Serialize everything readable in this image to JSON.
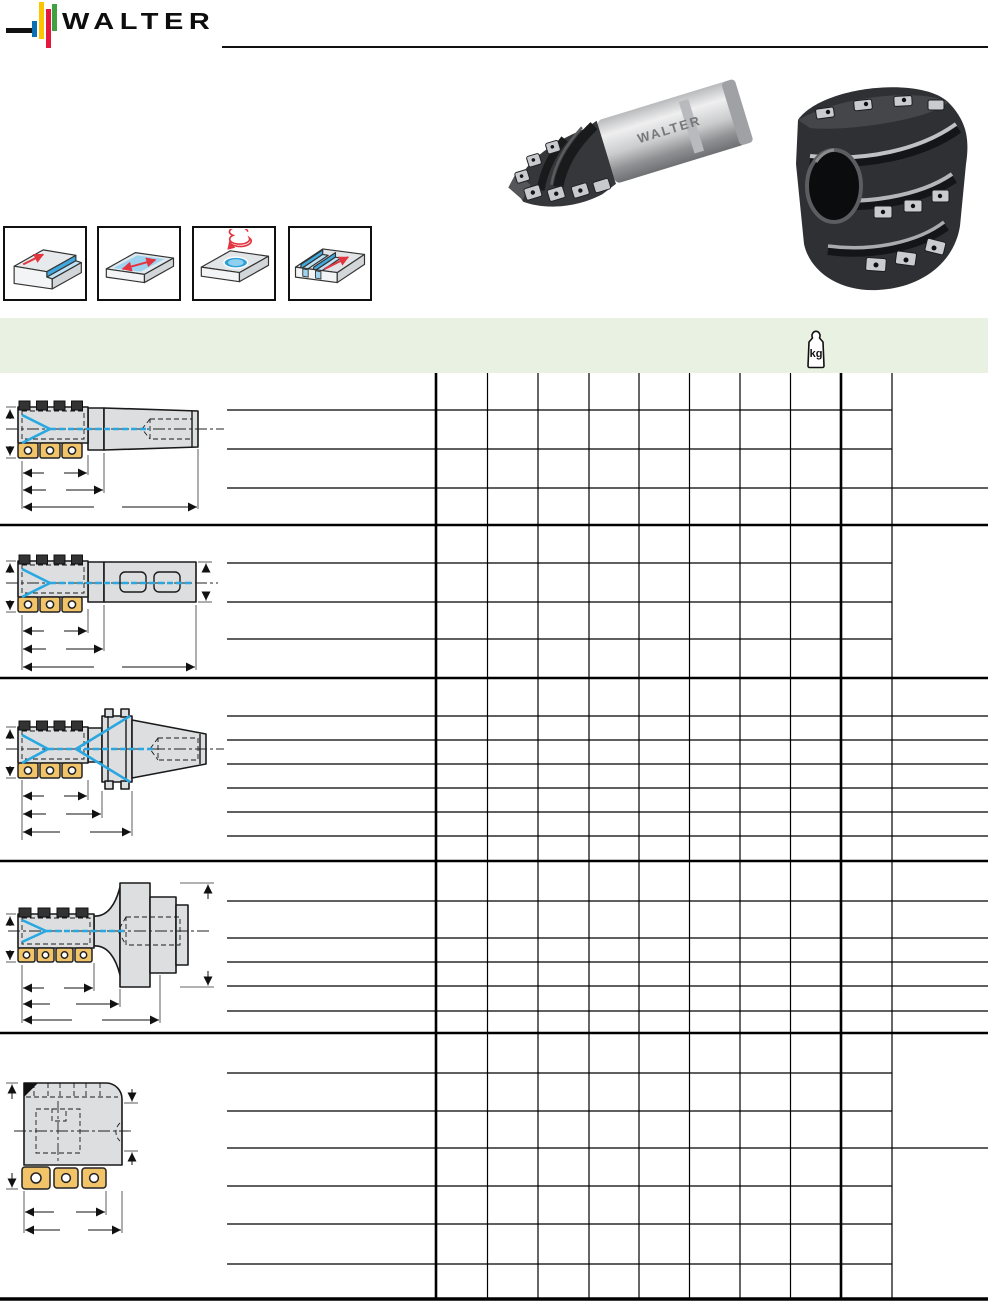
{
  "brand": {
    "logo_text": "WALTER"
  },
  "photos": {
    "shank_cutter_label": "WALTER",
    "left_photo": "porcupine-milling-cutter-with-cylindrical-shank-photo",
    "right_photo": "porcupine-milling-cutter-shell-type-photo"
  },
  "machining_icons": [
    {
      "name": "shoulder-milling-icon"
    },
    {
      "name": "face-milling-icon"
    },
    {
      "name": "circular-interpolation-milling-icon"
    },
    {
      "name": "slot-milling-icon"
    }
  ],
  "weight_header": {
    "unit_label": "kg"
  },
  "table": {
    "sections": [
      {
        "drawing": "cutter-with-cylindrical-shank",
        "data_rows": 4
      },
      {
        "drawing": "cutter-with-weldon-shank",
        "data_rows": 4
      },
      {
        "drawing": "cutter-with-iso-taper-shank",
        "data_rows": 7
      },
      {
        "drawing": "cutter-with-hsk-shank",
        "data_rows": 6
      },
      {
        "drawing": "shell-type-cutter-with-bore",
        "data_rows": 7
      }
    ],
    "cells_text": ""
  },
  "colors": {
    "band_green": "#e9f2e2",
    "insert_gold": "#f2c46a",
    "coolant_blue": "#29a7e0",
    "arrow_red": "#e23540",
    "logo_blue": "#0a6fb4",
    "logo_yellow": "#fdc400",
    "logo_red": "#e4183c",
    "logo_green": "#3fa142"
  }
}
